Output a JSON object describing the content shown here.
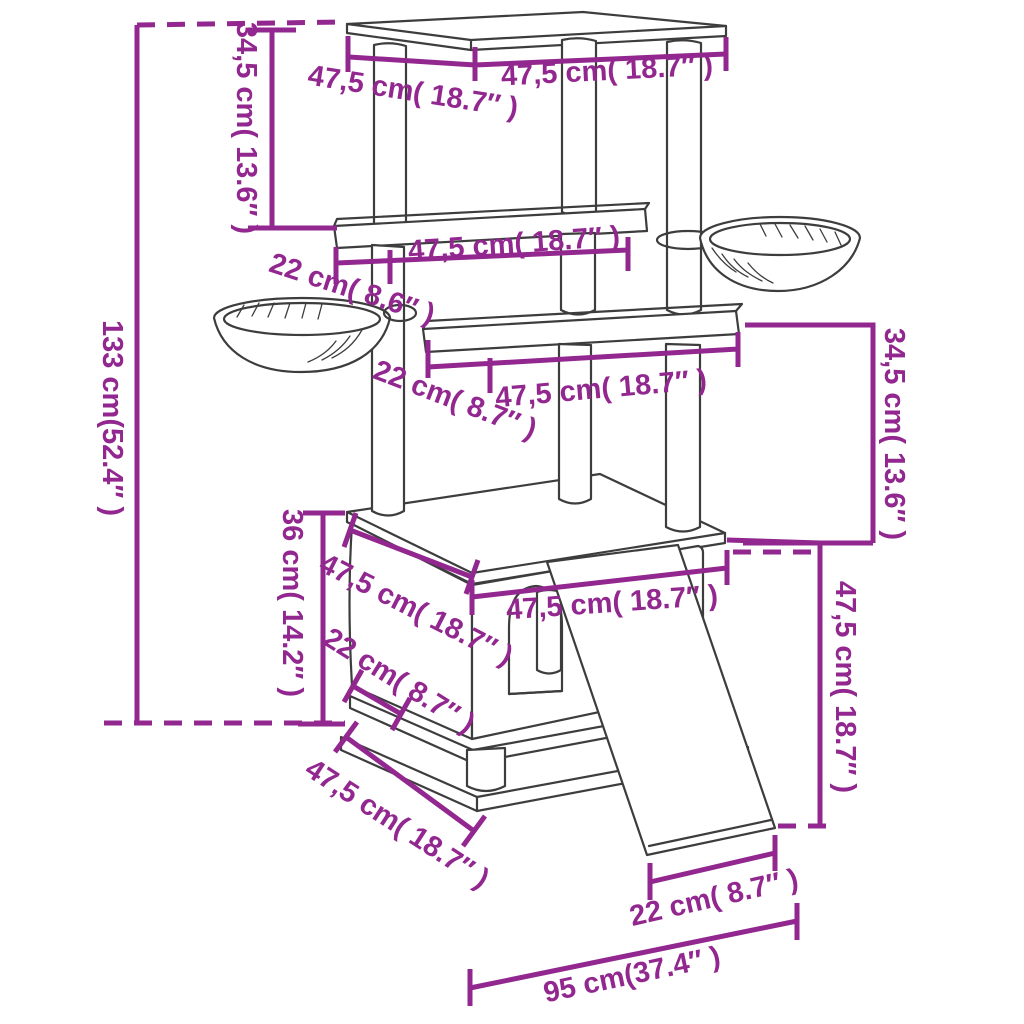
{
  "figure": {
    "subject": "Cat tree with scratching posts and baskets — dimension diagram",
    "background_color": "#ffffff",
    "dimension_color": "#92278F",
    "line_art_color": "#3d3d3d"
  },
  "dimensions": {
    "top_platform_depth": {
      "label": "47,5 cm( 18.7″ )"
    },
    "top_platform_width": {
      "label": "47,5 cm( 18.7″ )"
    },
    "upper_section_height": {
      "label": "34,5 cm( 13.6″ )"
    },
    "overall_height": {
      "label": "133 cm(52.4″ )"
    },
    "middle_shelf_width": {
      "label": "47,5 cm( 18.7″ )"
    },
    "middle_shelf_depth": {
      "label": "22 cm( 8.6″ )"
    },
    "lower_shelf_width": {
      "label": "47,5 cm( 18.7″ )"
    },
    "lower_shelf_depth": {
      "label": "22 cm( 8.7″ )"
    },
    "mid_section_height": {
      "label": "34,5 cm( 13.6″ )"
    },
    "condo_height": {
      "label": "36 cm( 14.2″ )"
    },
    "condo_top_depth": {
      "label": "47,5 cm( 18.7″ )"
    },
    "condo_top_width": {
      "label": "47,5 cm( 18.7″ )"
    },
    "condo_lower_depth": {
      "label": "22 cm( 8.7″ )"
    },
    "base_depth": {
      "label": "47,5 cm( 18.7″ )"
    },
    "ramp_height": {
      "label": "47,5 cm( 18.7″ )"
    },
    "ramp_foot_length": {
      "label": "22 cm( 8.7″ )"
    },
    "base_total_width": {
      "label": "95 cm(37.4″ )"
    }
  }
}
